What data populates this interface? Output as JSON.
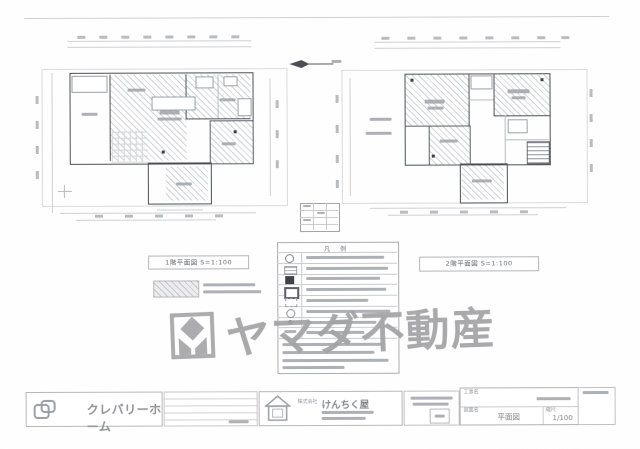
{
  "watermark": {
    "text": "ヤマダ不動産"
  },
  "plans": {
    "first": {
      "caption": "1階平面図 S=1:100"
    },
    "second": {
      "caption": "2階平面図 S=1:100"
    }
  },
  "legend": {
    "title": "凡 例"
  },
  "titleblock": {
    "brand": "クレバリーホーム",
    "company_prefix": "株式会社",
    "company": "けんちく屋",
    "project_label": "工事名",
    "drawing_label": "図面名",
    "drawing_name": "平面図",
    "scale_label": "縮尺",
    "scale_value": "1/100"
  }
}
